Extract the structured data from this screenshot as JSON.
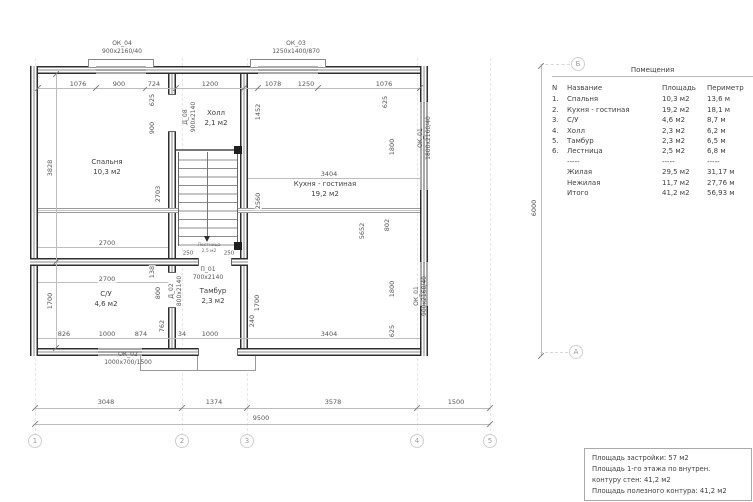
{
  "rooms": {
    "bedroom": {
      "name": "Спальня",
      "area": "10,3 м2"
    },
    "hall": {
      "name": "Холл",
      "area": "2,1 м2"
    },
    "kitchen": {
      "name": "Кухня - гостиная",
      "area": "19,2 м2"
    },
    "wc": {
      "name": "С/У",
      "area": "4,6 м2"
    },
    "tambour": {
      "name": "Тамбур",
      "area": "2,3 м2"
    },
    "stairs": {
      "name": "Лестница",
      "area": "2,5 м2"
    }
  },
  "windows": {
    "ok04": {
      "name": "ОК_04",
      "size": "900х2160/40"
    },
    "ok03": {
      "name": "ОК_03",
      "size": "1250х1400/870"
    },
    "ok01a": {
      "name": "ОК_01",
      "size": "1800х2160/40"
    },
    "ok01b": {
      "name": "ОК_01",
      "size": "900х2160/40"
    },
    "ok02": {
      "name": "ОК_02",
      "size": "1000х700/1500"
    }
  },
  "doors": {
    "p01": {
      "name": "П_01",
      "size": "700х2140"
    },
    "d02": {
      "name": "Д_02",
      "size": "800х2140"
    },
    "d08": {
      "name": "Д_08",
      "size": "900х2140"
    }
  },
  "dims": {
    "t1": "1076",
    "t2": "900",
    "t3": "724",
    "t4": "1200",
    "t5": "1078",
    "t6": "1250",
    "t7": "1076",
    "l1": "3828",
    "l2": "1700",
    "r6000": "6000",
    "b1": "3048",
    "b2": "1374",
    "b3": "3578",
    "b4": "1500",
    "b5": "9500",
    "i625a": "625",
    "i900": "900",
    "i2703": "2703",
    "i1452": "1452",
    "i2560": "2560",
    "i625b": "625",
    "i1800a": "1800",
    "i5652": "5652",
    "i802": "802",
    "i1800b": "1800",
    "i625c": "625",
    "i2700a": "2700",
    "i2700b": "2700",
    "i138": "138",
    "i800": "800",
    "i762": "762",
    "i826": "826",
    "i1000a": "1000",
    "i874": "874",
    "i34": "34",
    "i1000b": "1000",
    "i3404a": "3404",
    "i3404b": "3404",
    "i1700b": "1700",
    "i240": "240",
    "s250a": "250",
    "s250b": "250"
  },
  "grid": {
    "cols": [
      "1",
      "2",
      "3",
      "4",
      "5"
    ],
    "rowA": "А",
    "rowB": "Б"
  },
  "table": {
    "title": "Помещения",
    "headers": [
      "N",
      "Название",
      "Площадь",
      "Периметр"
    ],
    "rows": [
      [
        "1.",
        "Спальня",
        "10,3 м2",
        "13,6 м"
      ],
      [
        "2.",
        "Кухня - гостиная",
        "19,2 м2",
        "18,1 м"
      ],
      [
        "3.",
        "С/У",
        "4,6 м2",
        "8,7 м"
      ],
      [
        "4.",
        "Холл",
        "2,3 м2",
        "6,2 м"
      ],
      [
        "5.",
        "Тамбур",
        "2,3 м2",
        "6,5 м"
      ],
      [
        "6.",
        "Лестница",
        "2,5 м2",
        "6,8 м"
      ],
      [
        "",
        "-----",
        "-----",
        "-----"
      ],
      [
        "",
        "Жилая",
        "29,5 м2",
        "31,17 м"
      ],
      [
        "",
        "Нежилая",
        "11,7 м2",
        "27,76 м"
      ],
      [
        "",
        "Итого",
        "41,2 м2",
        "56,93 м"
      ]
    ]
  },
  "notes": {
    "line1": "Площадь застройки: 57 м2",
    "line2": "Площадь 1-го этажа по внутрен.",
    "line3": "контуру стен: 41,2 м2",
    "line4": "Площадь полезного контура: 41,2 м2"
  }
}
